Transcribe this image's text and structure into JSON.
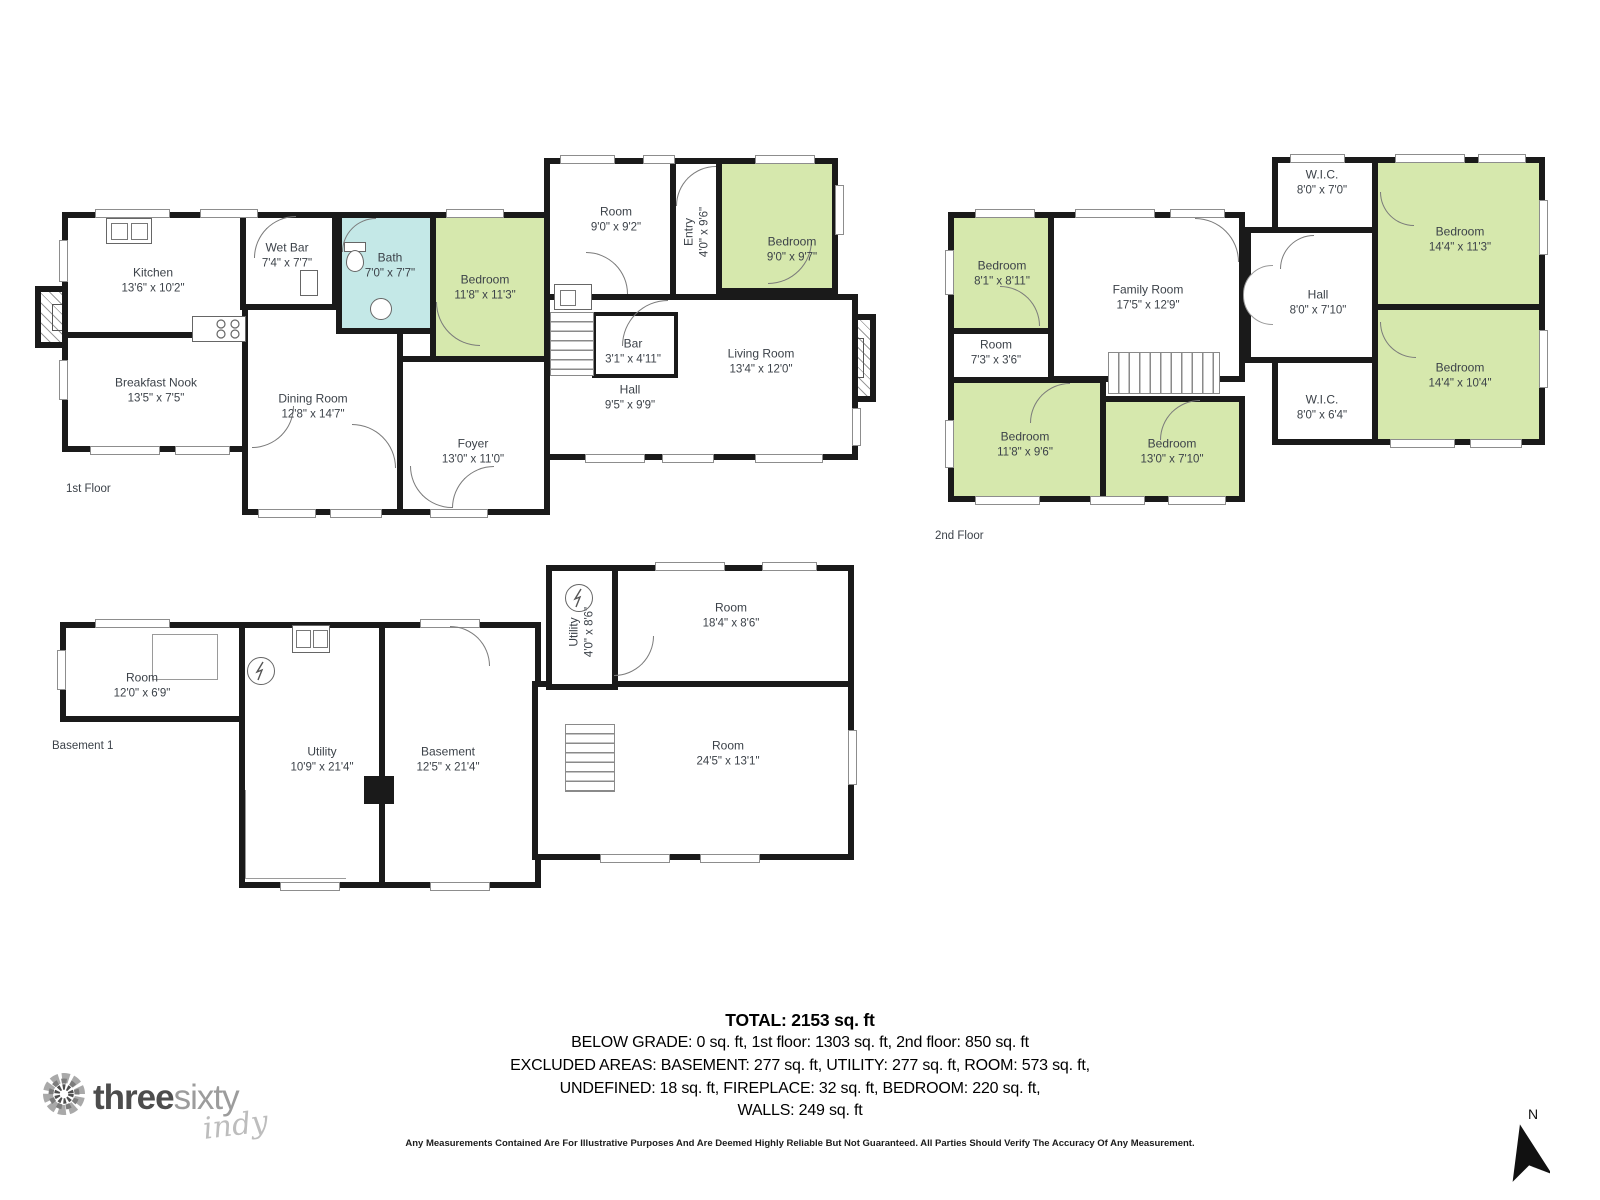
{
  "floors": {
    "first": {
      "label": "1st Floor",
      "rooms": [
        {
          "name": "Kitchen",
          "dims": "13'6\" x 10'2\""
        },
        {
          "name": "Wet Bar",
          "dims": "7'4\" x 7'7\""
        },
        {
          "name": "Bath",
          "dims": "7'0\" x 7'7\""
        },
        {
          "name": "Bedroom",
          "dims": "11'8\" x 11'3\""
        },
        {
          "name": "Breakfast Nook",
          "dims": "13'5\" x 7'5\""
        },
        {
          "name": "Dining Room",
          "dims": "12'8\" x 14'7\""
        },
        {
          "name": "Foyer",
          "dims": "13'0\" x 11'0\""
        },
        {
          "name": "Room",
          "dims": "9'0\" x 9'2\""
        },
        {
          "name": "Entry",
          "dims": "4'0\" x 9'6\""
        },
        {
          "name": "Bedroom",
          "dims": "9'0\" x 9'7\""
        },
        {
          "name": "Bar",
          "dims": "3'1\" x 4'11\""
        },
        {
          "name": "Hall",
          "dims": "9'5\" x 9'9\""
        },
        {
          "name": "Living Room",
          "dims": "13'4\" x 12'0\""
        }
      ]
    },
    "second": {
      "label": "2nd Floor",
      "rooms": [
        {
          "name": "Bedroom",
          "dims": "8'1\" x 8'11\""
        },
        {
          "name": "Family Room",
          "dims": "17'5\" x 12'9\""
        },
        {
          "name": "Room",
          "dims": "7'3\" x 3'6\""
        },
        {
          "name": "Bedroom",
          "dims": "11'8\" x 9'6\""
        },
        {
          "name": "Bedroom",
          "dims": "13'0\" x 7'10\""
        },
        {
          "name": "W.I.C.",
          "dims": "8'0\" x 7'0\""
        },
        {
          "name": "Hall",
          "dims": "8'0\" x 7'10\""
        },
        {
          "name": "W.I.C.",
          "dims": "8'0\" x 6'4\""
        },
        {
          "name": "Bedroom",
          "dims": "14'4\" x 11'3\""
        },
        {
          "name": "Bedroom",
          "dims": "14'4\" x 10'4\""
        }
      ]
    },
    "basement": {
      "label": "Basement 1",
      "rooms": [
        {
          "name": "Room",
          "dims": "12'0\" x 6'9\""
        },
        {
          "name": "Utility",
          "dims": "10'9\" x 21'4\""
        },
        {
          "name": "Basement",
          "dims": "12'5\" x 21'4\""
        },
        {
          "name": "Utility",
          "dims": "4'0\" x 8'6\""
        },
        {
          "name": "Room",
          "dims": "18'4\" x 8'6\""
        },
        {
          "name": "Room",
          "dims": "24'5\" x 13'1\""
        }
      ]
    }
  },
  "summary": {
    "total": "TOTAL: 2153 sq. ft",
    "lines": [
      "BELOW GRADE: 0 sq. ft, 1st floor: 1303 sq. ft, 2nd floor: 850 sq. ft",
      "EXCLUDED AREAS: BASEMENT: 277 sq. ft, UTILITY: 277 sq. ft, ROOM: 573 sq. ft,",
      "UNDEFINED: 18 sq. ft, FIREPLACE: 32 sq. ft, BEDROOM: 220 sq. ft,",
      "WALLS: 249 sq. ft"
    ]
  },
  "disclaimer": "Any Measurements Contained Are For Illustrative Purposes And Are Deemed Highly Reliable But Not Guaranteed. All Parties Should Verify The Accuracy Of Any Measurement.",
  "logo": {
    "word1": "three",
    "word2": "sixty",
    "script": "indy"
  },
  "compass": {
    "north_label": "N"
  },
  "colors": {
    "wall": "#1a1a1a",
    "bedroom_green": "#d6e8ad",
    "bath_blue": "#c4e8e7",
    "label_text": "#3c4249"
  }
}
